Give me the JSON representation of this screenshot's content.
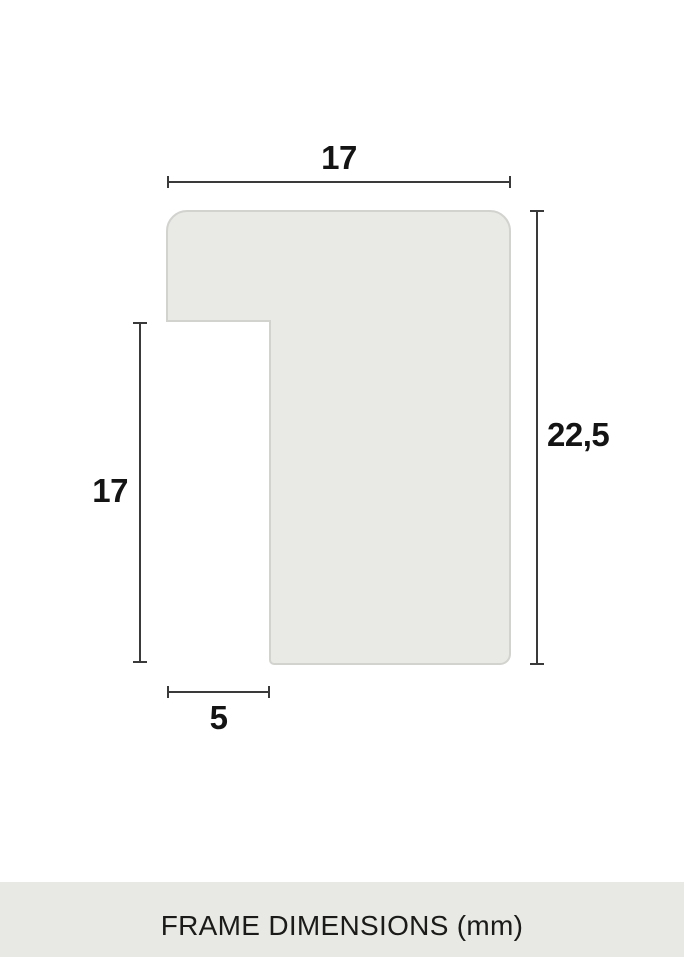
{
  "diagram": {
    "caption": "FRAME DIMENSIONS (mm)",
    "dimensions": {
      "top_width_mm": "17",
      "right_height_mm": "22,5",
      "left_height_mm": "17",
      "bottom_width_mm": "5"
    },
    "colors": {
      "background": "#ffffff",
      "profile_fill": "#e9e9e6",
      "profile_border": "#d2d2cf",
      "dimension_line": "#3a3a3a",
      "label_text": "#141414",
      "caption_bar_bg": "#e8e8e4",
      "caption_text": "#1b1b19"
    }
  }
}
